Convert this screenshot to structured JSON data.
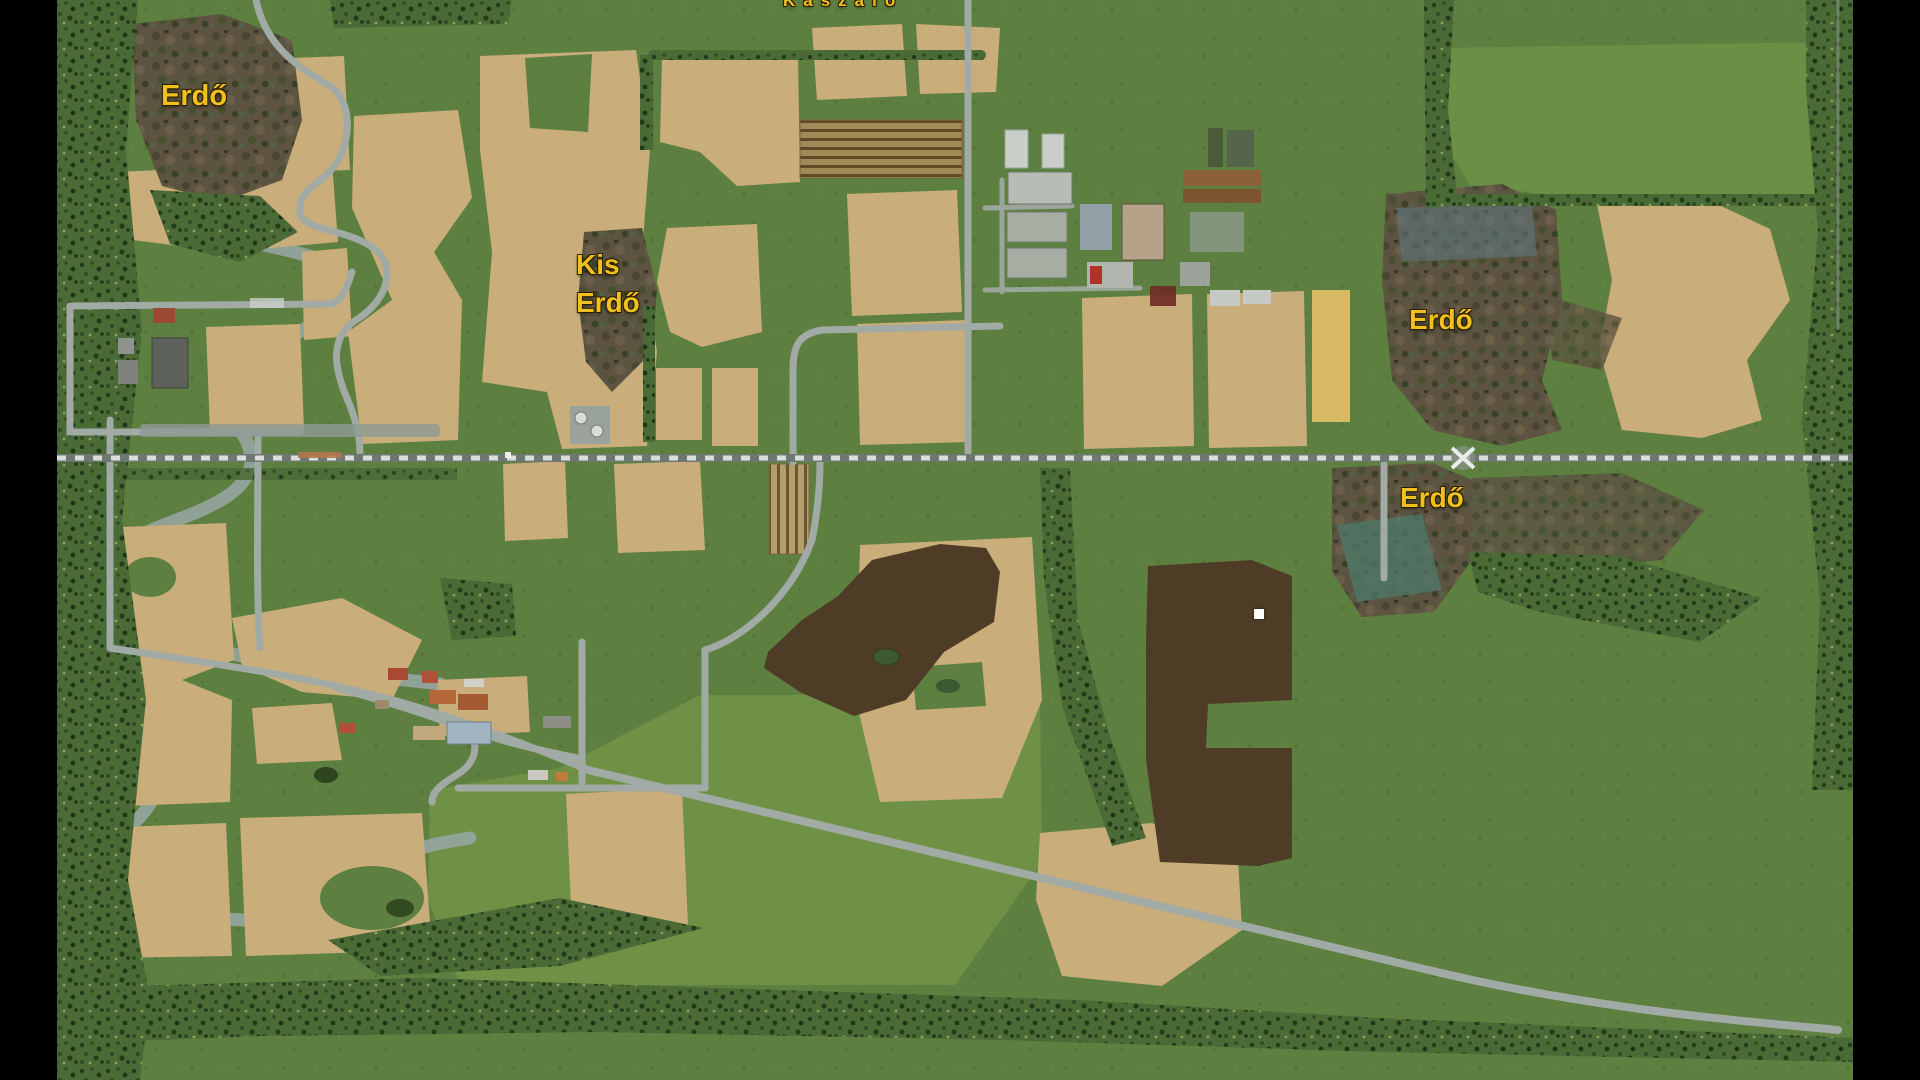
{
  "screen": {
    "width": 1920,
    "height": 1080,
    "letterbox_color": "#000000"
  },
  "map": {
    "labels": [
      {
        "id": "kaszalo",
        "text": "Kaszáló"
      },
      {
        "id": "erdo-northwest",
        "text": "Erdő"
      },
      {
        "id": "kis-erdo",
        "line1": "Kis",
        "line2": "Erdő"
      },
      {
        "id": "erdo-east-upper",
        "text": "Erdő"
      },
      {
        "id": "erdo-east-lower",
        "text": "Erdő"
      }
    ],
    "label_style": {
      "color": "#f0c11c",
      "outline": "#2b1f00"
    },
    "marker": {
      "name": "white-waypoint-dot",
      "x": 1254,
      "y": 609
    },
    "palette": {
      "grass": "#5d8041",
      "grass_light": "#719447",
      "field_tan": "#c9ad7b",
      "field_yellow": "#d8ba66",
      "plowed_brown": "#4e3c26",
      "forest_brown": "#5c5340",
      "tree_dark": "#24391b",
      "road_gray": "#a2aaa5",
      "rail_light": "#dadedb",
      "stream_gray": "#95a59f",
      "pond_teal": "#4e7a6b"
    }
  }
}
